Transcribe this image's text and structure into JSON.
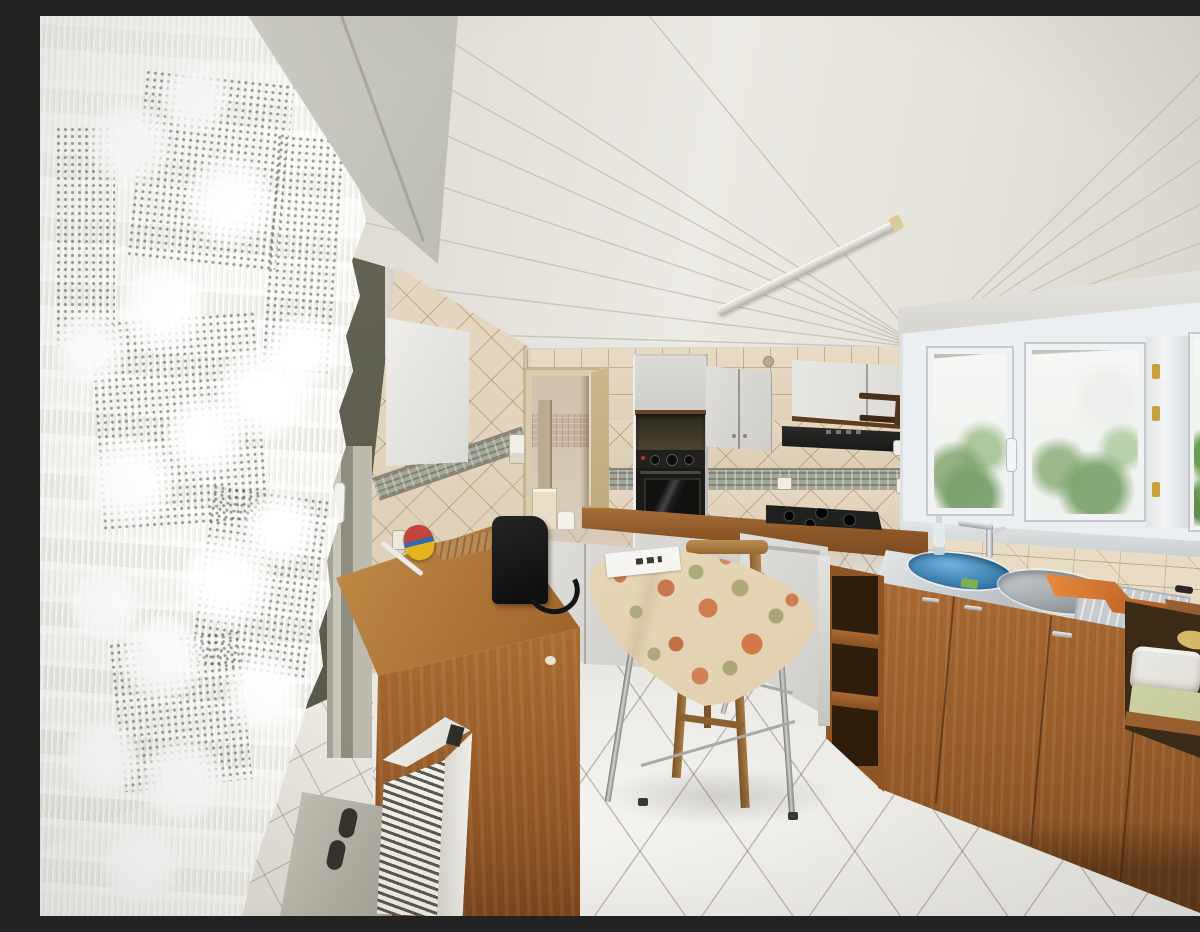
{
  "scene": {
    "description": "Daylit empty kitchen photograph: white plank ceiling with fluorescent tube light, white pelmet and lace curtain over the left window, beige tiled walls with a grey mosaic border, doorway to a small bathroom with vanity and toilet, white upper cabinets with built-in black oven and black range hood, gas hob on brown worktop, white PVC window with garden greenery above a stainless double sink with blue basin, oak base cabinets with open shelves and towels, small dining table with cream floral tablecloth and wooden chair, brown sideboard with black bag and fly swatter, white finned electric radiator and grey board leaning on the wall, diagonal white tiled floor.",
    "text_content": "none — photograph contains no readable text"
  },
  "palette": {
    "ceiling": "#e9e6df",
    "wall_tile": "#e3d5bf",
    "grout": "#b29b77",
    "mosaic_border": "#a4a798",
    "cabinet_white": "#d9d8d4",
    "wood_trim": "#6d4526",
    "oven_black": "#1b1a18",
    "counter_wood": "#8a5526",
    "cabinet_oak": "#9a5b2a",
    "sink_steel": "#c3c8cb",
    "basin_blue": "#3f86bb",
    "tablecloth_cream": "#ecdcb8",
    "flower_salmon": "#c97a4d",
    "leaf_sage": "#a3a878",
    "floor": "#e8e6e1",
    "curtain_white": "#fbfbf8",
    "window_frame": "#eef0f2",
    "greenery": "#6f9e55",
    "radiator_white": "#ece9e4",
    "bag_black": "#161616",
    "cloth_orange": "#e08038",
    "grey_board": "#b4b0a5"
  },
  "objects": [
    {
      "id": "ceiling",
      "label": "white plank ceiling"
    },
    {
      "id": "ceiling-light",
      "label": "fluorescent tube light"
    },
    {
      "id": "window-pelmet-beam",
      "label": "white pelmet beam"
    },
    {
      "id": "lace-curtain",
      "label": "white lace curtain"
    },
    {
      "id": "left-window",
      "label": "window behind curtain"
    },
    {
      "id": "left-wall-tiles",
      "label": "tiled left wall"
    },
    {
      "id": "wall-panel",
      "label": "white wall panel"
    },
    {
      "id": "doorway",
      "label": "doorway to bathroom"
    },
    {
      "id": "bathroom-vanity",
      "label": "cream vanity"
    },
    {
      "id": "toilet",
      "label": "white toilet"
    },
    {
      "id": "oven-column",
      "label": "tall oven housing"
    },
    {
      "id": "built-in-oven",
      "label": "black built-in oven"
    },
    {
      "id": "upper-cabinets",
      "label": "white upper cabinets"
    },
    {
      "id": "hood-cabinet",
      "label": "cabinet above hood"
    },
    {
      "id": "range-hood",
      "label": "black range hood"
    },
    {
      "id": "towel-bar",
      "label": "wooden towel bar"
    },
    {
      "id": "paper-dispenser",
      "label": "wooden wall dispenser"
    },
    {
      "id": "light-switch",
      "label": "light switch"
    },
    {
      "id": "power-outlet",
      "label": "power outlet"
    },
    {
      "id": "back-counter",
      "label": "brown worktop"
    },
    {
      "id": "gas-hob",
      "label": "black gas hob"
    },
    {
      "id": "dishwasher-cabinet",
      "label": "white base unit"
    },
    {
      "id": "base-cabinets-white",
      "label": "white drawers with wood handles"
    },
    {
      "id": "open-shelf-unit",
      "label": "oak open shelf unit"
    },
    {
      "id": "kitchen-window",
      "label": "PVC kitchen window"
    },
    {
      "id": "window-handle",
      "label": "white window handle"
    },
    {
      "id": "garden-greenery",
      "label": "greenery outside"
    },
    {
      "id": "backsplash",
      "label": "tiled backsplash"
    },
    {
      "id": "sink",
      "label": "stainless double sink"
    },
    {
      "id": "blue-basin",
      "label": "blue washing-up bowl"
    },
    {
      "id": "faucet",
      "label": "chrome mixer tap"
    },
    {
      "id": "soap-bottle",
      "label": "soap bottle"
    },
    {
      "id": "sponge",
      "label": "green sponge"
    },
    {
      "id": "orange-cloths",
      "label": "orange cloths on drainer"
    },
    {
      "id": "drain-board",
      "label": "stainless drain board"
    },
    {
      "id": "sink-cabinets",
      "label": "oak sink cabinets"
    },
    {
      "id": "towel-shelf",
      "label": "shelf with towels"
    },
    {
      "id": "door-frame-right",
      "label": "dark frame at right edge"
    },
    {
      "id": "tile-floor",
      "label": "diagonal white tile floor"
    },
    {
      "id": "dining-table",
      "label": "small dining table"
    },
    {
      "id": "tablecloth",
      "label": "cream floral tablecloth"
    },
    {
      "id": "booklet",
      "label": "white booklet on table"
    },
    {
      "id": "wooden-chair",
      "label": "wooden chair"
    },
    {
      "id": "sideboard",
      "label": "brown sideboard"
    },
    {
      "id": "black-bag",
      "label": "black bag"
    },
    {
      "id": "fly-swatter",
      "label": "colourful fly swatter"
    },
    {
      "id": "radiator",
      "label": "white finned radiator"
    },
    {
      "id": "grey-board",
      "label": "grey board leaning on wall"
    },
    {
      "id": "white-tile-wall",
      "label": "white tiled wall section"
    }
  ]
}
